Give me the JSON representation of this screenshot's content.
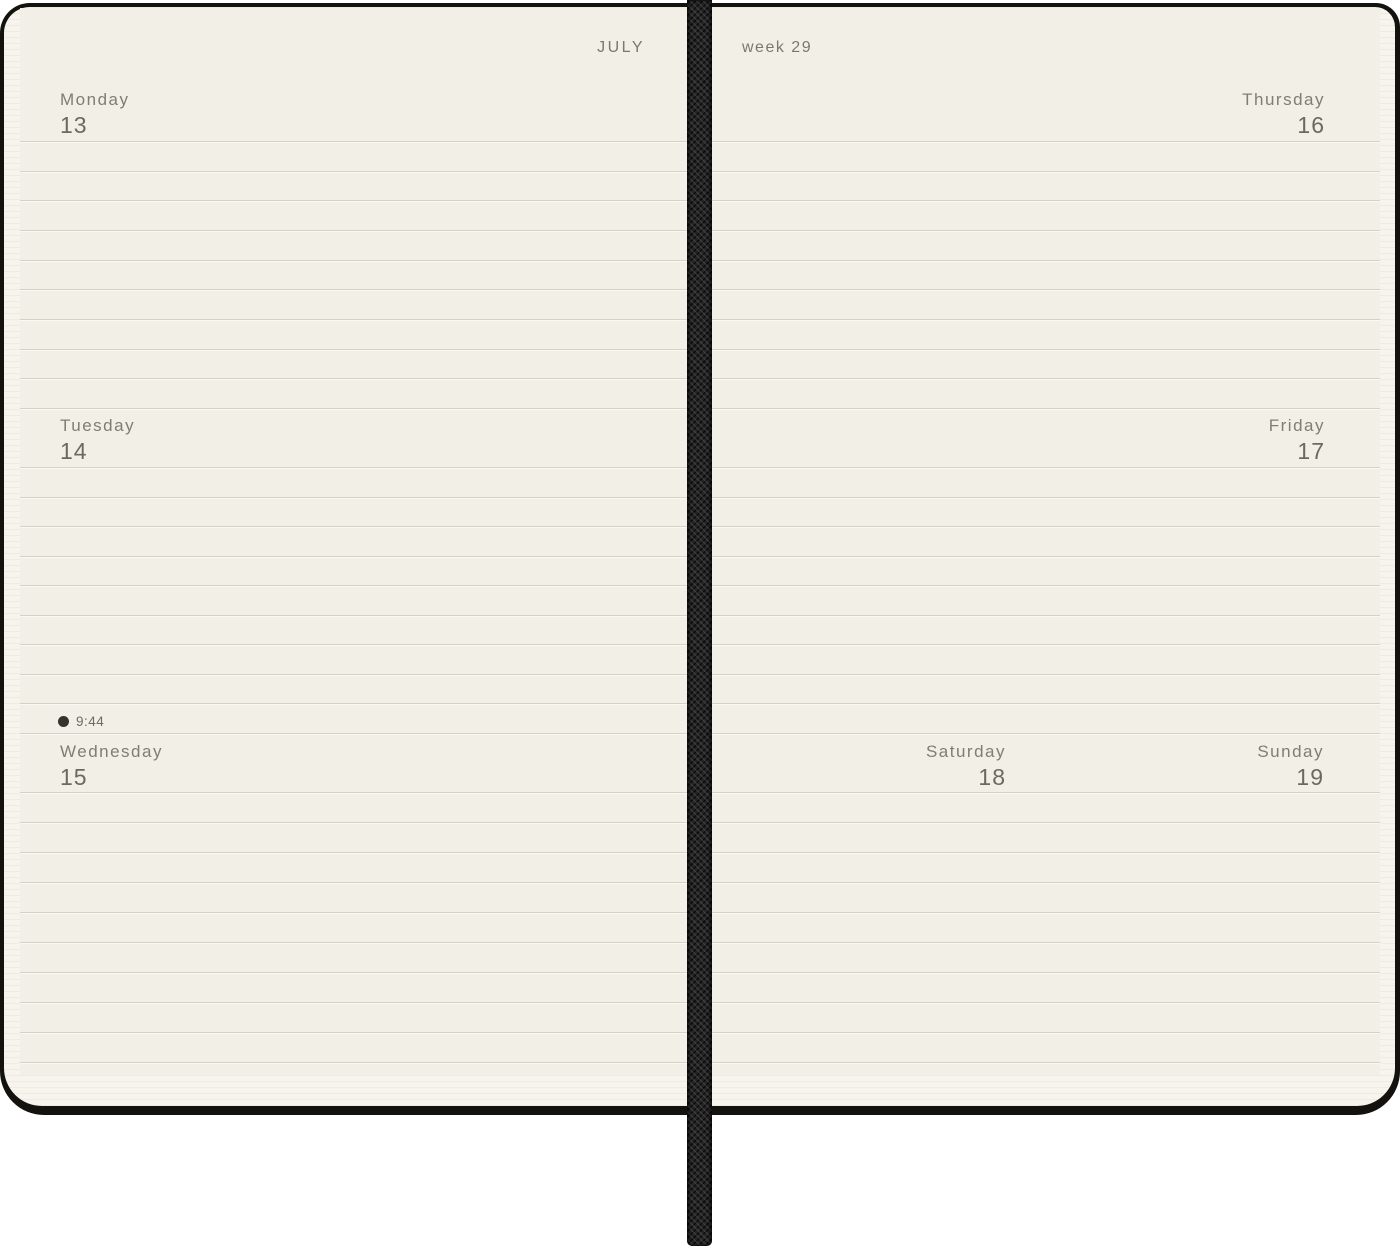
{
  "header": {
    "month": "JULY",
    "week_label": "week 29"
  },
  "days": [
    {
      "name": "Monday",
      "number": "13"
    },
    {
      "name": "Tuesday",
      "number": "14"
    },
    {
      "name": "Wednesday",
      "number": "15"
    },
    {
      "name": "Thursday",
      "number": "16"
    },
    {
      "name": "Friday",
      "number": "17"
    },
    {
      "name": "Saturday",
      "number": "18"
    },
    {
      "name": "Sunday",
      "number": "19"
    }
  ],
  "marker": {
    "icon": "new-moon-icon",
    "time": "9:44"
  },
  "colors": {
    "background": "#ffffff",
    "cover": "#14120f",
    "page": "#f2efe7",
    "rule_line": "#d5d1c5",
    "header_text": "#7c786e",
    "day_name_text": "#817d74",
    "day_number_text": "#6d6961",
    "ribbon": "#1b1b1b"
  }
}
